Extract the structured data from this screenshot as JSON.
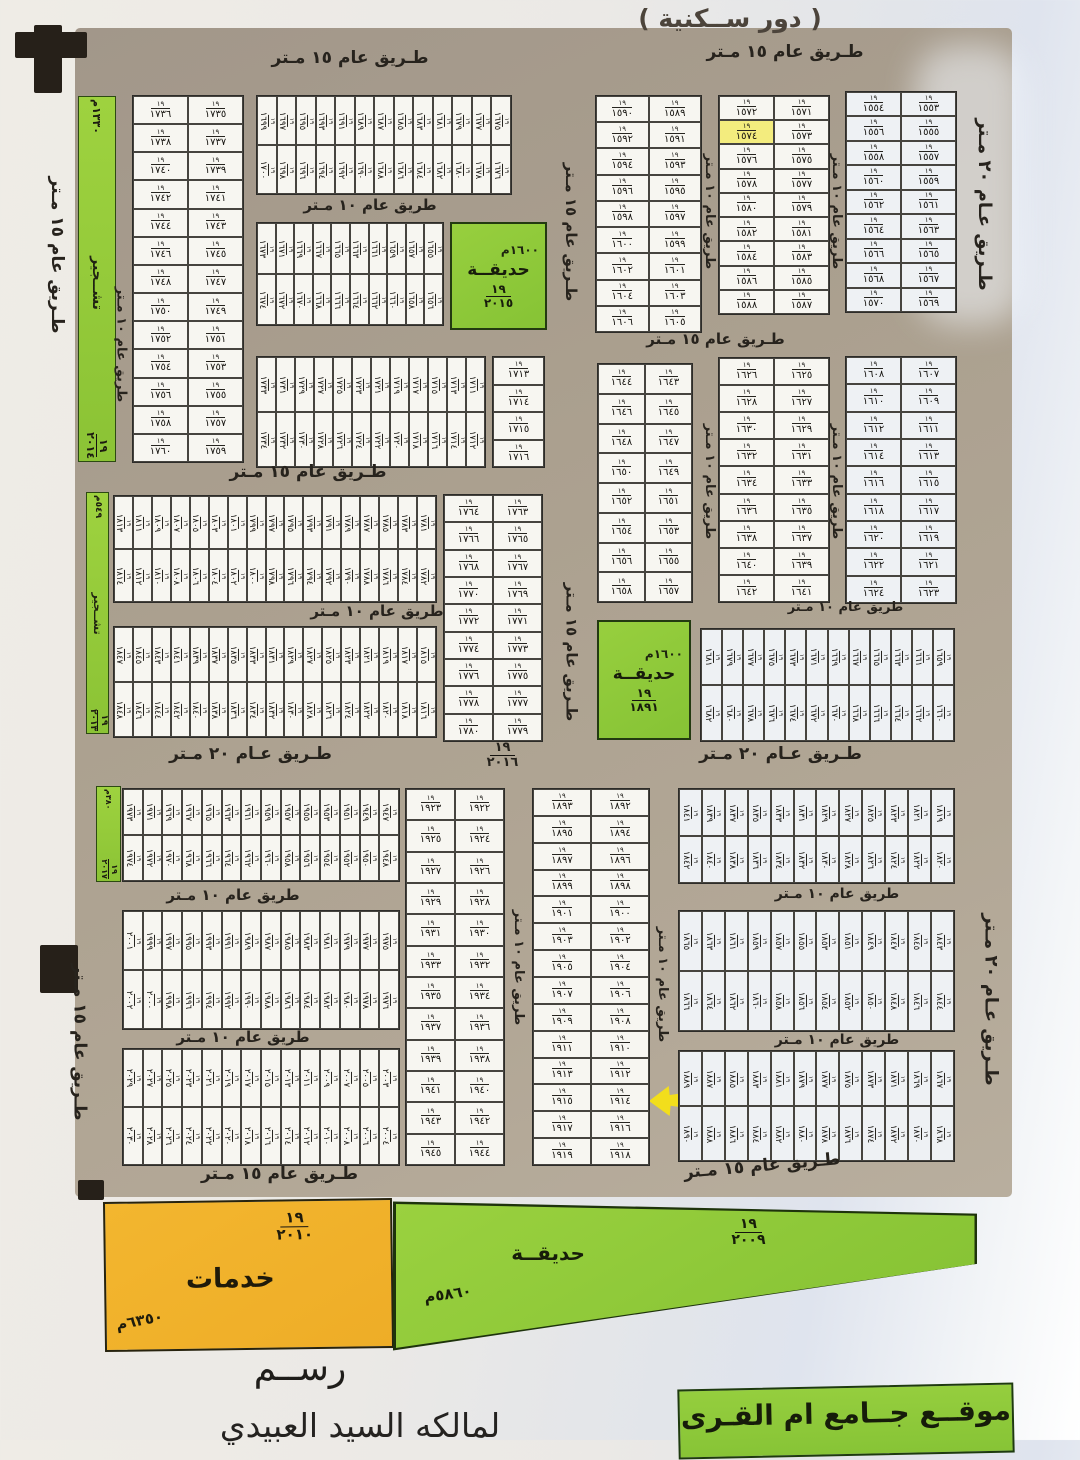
{
  "title": "( دور ســكنية )",
  "road_labels": {
    "r15": "طـريق عام ١٥ مـتر",
    "r10": "طريق عام ١٠ مـتر",
    "r20": "طـريق عـام ٢٠ مـتر"
  },
  "plot_prefix": "١٩",
  "highlight": {
    "yellow_cell": 1574,
    "arrow_plot": 1914
  },
  "areas": {
    "tashjeer_top": {
      "frac_top": "١٩",
      "frac_bottom": "٢٠١٤",
      "label": "تشــجير",
      "area": "١٣٣٠م"
    },
    "tashjeer_mid": {
      "frac_top": "١٩",
      "frac_bottom": "٢٠١٣",
      "label": "تشــجير",
      "area": "٥٤٩م"
    },
    "tashjeer_side": {
      "frac_top": "١٩",
      "frac_bottom": "٢٠١٧",
      "area": "٣٨٠م"
    },
    "garden_top": {
      "area": "١٦٠٠م",
      "label": "حديقــة",
      "frac_top": "١٩",
      "frac_bottom": "٢٠١٥"
    },
    "garden_mid": {
      "area": "١٦٠٠م",
      "label": "حديقــة",
      "frac_top": "١٩",
      "frac_bottom": "١٨٩١"
    },
    "garden_bottom": {
      "label": "حديقــة",
      "frac_top": "١٩",
      "frac_bottom": "٢٠٠٩",
      "area": "٥٨٦٠م"
    },
    "services": {
      "label": "خدمات",
      "frac_top": "١٩",
      "frac_bottom": "٢٠١٠",
      "area": "٦٣٥٠م"
    },
    "road_parcel": {
      "frac_top": "١٩",
      "frac_bottom": "٢٠١٦"
    }
  },
  "footer": {
    "drawing": "رســم",
    "owner": "لمالكه السيد العبيدي",
    "mosque": "موقــع جــامع ام القـرى"
  },
  "map": {
    "blocks": [
      {
        "id": "B",
        "type": "2col",
        "x": 132,
        "y": 95,
        "w": 112,
        "h": 368,
        "rows": 13,
        "right_start": 1735,
        "left_start": 1736
      },
      {
        "id": "E",
        "type": "2col",
        "x": 595,
        "y": 95,
        "w": 107,
        "h": 238,
        "rows": 9,
        "right_start": 1589,
        "left_start": 1590
      },
      {
        "id": "F",
        "type": "2col",
        "x": 718,
        "y": 95,
        "w": 112,
        "h": 220,
        "rows": 9,
        "right_start": 1571,
        "left_start": 1572
      },
      {
        "id": "G",
        "type": "2col",
        "x": 845,
        "y": 91,
        "w": 112,
        "h": 222,
        "rows": 9,
        "right_start": 1553,
        "left_start": 1554,
        "tint": true
      },
      {
        "id": "K",
        "type": "2col",
        "x": 597,
        "y": 363,
        "w": 96,
        "h": 240,
        "rows": 8,
        "right_start": 1643,
        "left_start": 1644
      },
      {
        "id": "L",
        "type": "2col",
        "x": 718,
        "y": 357,
        "w": 112,
        "h": 246,
        "rows": 9,
        "right_start": 1625,
        "left_start": 1626
      },
      {
        "id": "M",
        "type": "2col",
        "x": 845,
        "y": 356,
        "w": 112,
        "h": 248,
        "rows": 9,
        "right_start": 1607,
        "left_start": 1608,
        "tint": true
      },
      {
        "id": "N",
        "type": "2col",
        "x": 443,
        "y": 494,
        "w": 100,
        "h": 248,
        "rows": 9,
        "right_start": 1763,
        "left_start": 1764
      },
      {
        "id": "P",
        "type": "2col",
        "x": 405,
        "y": 788,
        "w": 100,
        "h": 378,
        "rows": 12,
        "right_start": 1922,
        "left_start": 1923
      },
      {
        "id": "Q",
        "type": "2col",
        "x": 532,
        "y": 788,
        "w": 118,
        "h": 378,
        "rows": 14,
        "right_start": 1892,
        "left_start": 1893
      },
      {
        "id": "S1",
        "type": "col1",
        "x": 492,
        "y": 356,
        "w": 53,
        "h": 112,
        "values": [
          1713,
          1714,
          1715,
          1716
        ]
      },
      {
        "id": "C",
        "type": "stripe",
        "x": 256,
        "y": 95,
        "w": 256,
        "h": 100,
        "cols": 13,
        "start": 1699
      },
      {
        "id": "D",
        "type": "stripe",
        "x": 256,
        "y": 222,
        "w": 188,
        "h": 104,
        "cols": 10,
        "start": 1673
      },
      {
        "id": "H",
        "type": "stripe",
        "x": 256,
        "y": 356,
        "w": 230,
        "h": 112,
        "cols": 12,
        "start": 1733
      },
      {
        "id": "MS1",
        "type": "stripe",
        "x": 113,
        "y": 495,
        "w": 324,
        "h": 108,
        "cols": 17,
        "start": 1813
      },
      {
        "id": "MS2",
        "type": "stripe",
        "x": 113,
        "y": 626,
        "w": 324,
        "h": 112,
        "cols": 17,
        "start": 1847
      },
      {
        "id": "RM",
        "type": "stripe",
        "x": 700,
        "y": 628,
        "w": 255,
        "h": 114,
        "cols": 12,
        "start": 1681,
        "tint": true
      },
      {
        "id": "LB1",
        "type": "stripe",
        "x": 122,
        "y": 788,
        "w": 278,
        "h": 94,
        "cols": 14,
        "start": 1973
      },
      {
        "id": "LB2",
        "type": "stripe",
        "x": 122,
        "y": 910,
        "w": 278,
        "h": 120,
        "cols": 14,
        "start": 2001
      },
      {
        "id": "LB3",
        "type": "stripe",
        "x": 122,
        "y": 1048,
        "w": 278,
        "h": 118,
        "cols": 14,
        "start": 2029
      },
      {
        "id": "RB1",
        "type": "stripe",
        "x": 678,
        "y": 788,
        "w": 277,
        "h": 96,
        "cols": 12,
        "start": 1841,
        "tint": true
      },
      {
        "id": "RB2",
        "type": "stripe",
        "x": 678,
        "y": 910,
        "w": 277,
        "h": 122,
        "cols": 12,
        "start": 1865,
        "tint": true
      },
      {
        "id": "RB3",
        "type": "stripe",
        "x": 678,
        "y": 1050,
        "w": 277,
        "h": 112,
        "cols": 12,
        "start": 1889,
        "tint": true
      }
    ],
    "road_label_placements": [
      {
        "key": "r15",
        "x": 200,
        "y": 48,
        "w": 300
      },
      {
        "key": "r15",
        "x": 630,
        "y": 42,
        "w": 310
      },
      {
        "key": "r10",
        "x": 245,
        "y": 196,
        "w": 250,
        "fs": 15
      },
      {
        "key": "r15",
        "x": 628,
        "y": 330,
        "w": 175,
        "fs": 15
      },
      {
        "key": "r15",
        "x": 168,
        "y": 462,
        "w": 280
      },
      {
        "key": "r10",
        "x": 252,
        "y": 602,
        "w": 250,
        "fs": 15
      },
      {
        "key": "r10",
        "x": 778,
        "y": 600,
        "w": 135,
        "fs": 13
      },
      {
        "key": "r20",
        "x": 138,
        "y": 744,
        "w": 225
      },
      {
        "key": "r20",
        "x": 648,
        "y": 744,
        "w": 265
      },
      {
        "key": "r10",
        "x": 128,
        "y": 886,
        "w": 210,
        "fs": 15
      },
      {
        "key": "r10",
        "x": 742,
        "y": 886,
        "w": 190,
        "fs": 14
      },
      {
        "key": "r10",
        "x": 138,
        "y": 1028,
        "w": 210,
        "fs": 15
      },
      {
        "key": "r10",
        "x": 742,
        "y": 1032,
        "w": 190,
        "fs": 14
      },
      {
        "key": "r15",
        "x": 162,
        "y": 1164,
        "w": 235
      },
      {
        "key": "r15",
        "x": 612,
        "y": 1156,
        "w": 300,
        "tilt": -5
      },
      {
        "key": "r15",
        "cx": 57,
        "cy": 255,
        "len": 190,
        "rot": true
      },
      {
        "key": "r10",
        "cx": 121,
        "cy": 345,
        "len": 220,
        "rot": true,
        "fs": 13
      },
      {
        "key": "r15",
        "cx": 571,
        "cy": 232,
        "len": 200,
        "rot": true,
        "fs": 15
      },
      {
        "key": "r10",
        "cx": 709,
        "cy": 212,
        "len": 165,
        "rot": true,
        "fs": 13
      },
      {
        "key": "r10",
        "cx": 836,
        "cy": 212,
        "len": 165,
        "rot": true,
        "fs": 13
      },
      {
        "key": "r10",
        "cx": 709,
        "cy": 482,
        "len": 165,
        "rot": true,
        "fs": 13
      },
      {
        "key": "r10",
        "cx": 836,
        "cy": 482,
        "len": 165,
        "rot": true,
        "fs": 13
      },
      {
        "key": "r15",
        "cx": 571,
        "cy": 652,
        "len": 185,
        "rot": true,
        "fs": 15
      },
      {
        "key": "r20",
        "cx": 984,
        "cy": 205,
        "len": 205,
        "rot": true,
        "fs": 18
      },
      {
        "key": "r10",
        "cx": 518,
        "cy": 968,
        "len": 185,
        "rot": true,
        "fs": 13
      },
      {
        "key": "r10",
        "cx": 662,
        "cy": 985,
        "len": 185,
        "rot": true,
        "fs": 13
      },
      {
        "key": "r15",
        "cx": 79,
        "cy": 1042,
        "len": 195,
        "rot": true
      },
      {
        "key": "r20",
        "cx": 991,
        "cy": 1000,
        "len": 220,
        "rot": true,
        "fs": 18
      }
    ]
  }
}
